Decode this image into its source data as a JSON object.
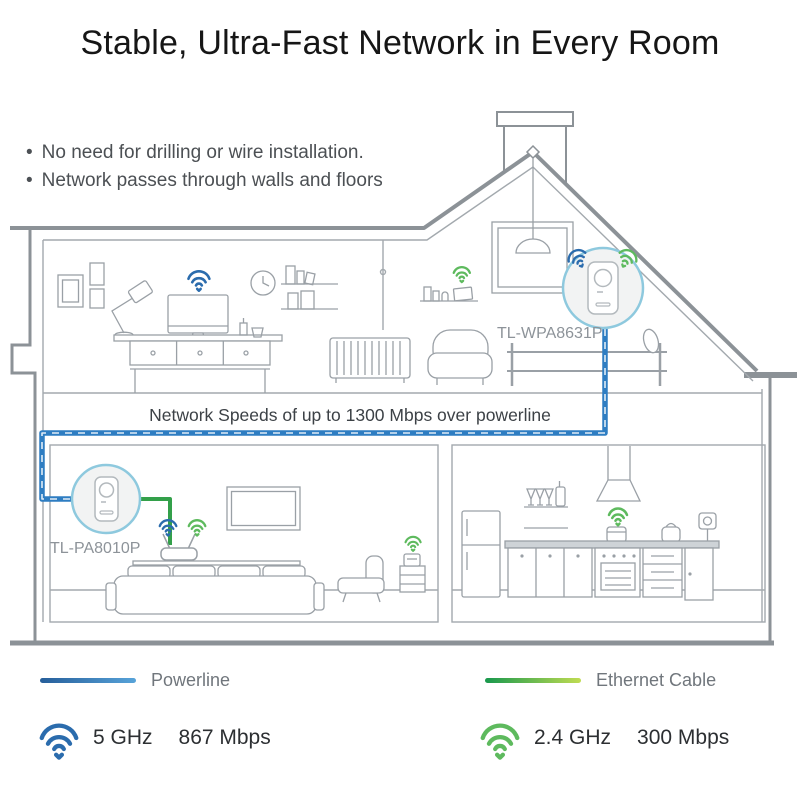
{
  "title": "Stable, Ultra-Fast Network in Every Room",
  "bullets": [
    "No need for drilling or wire installation.",
    "Network passes through walls and floors"
  ],
  "diagram": {
    "banner": "Network Speeds of up to 1300 Mbps over powerline",
    "upper_device": {
      "label": "TL-WPA8631P"
    },
    "lower_device": {
      "label": "TL-PA8010P"
    }
  },
  "legend": {
    "powerline": {
      "label": "Powerline",
      "color_start": "#265e9a",
      "color_end": "#57a3d9"
    },
    "ethernet": {
      "label": "Ethernet Cable",
      "color_start": "#18984d",
      "color_end": "#c0dc52"
    }
  },
  "speeds": {
    "wifi5": {
      "band": "5 GHz",
      "rate": "867 Mbps",
      "color": "#2b6cad"
    },
    "wifi24": {
      "band": "2.4 GHz",
      "rate": "300 Mbps",
      "color": "#5eba5e"
    }
  },
  "colors": {
    "powerline_cable": "#2e7dc2",
    "ethernet_cable": "#33a04a",
    "wifi_blue": "#2b6cad",
    "wifi_green": "#5eba5e",
    "device_circle_border": "#8ec9de",
    "line_art": "#9aa0a6"
  }
}
